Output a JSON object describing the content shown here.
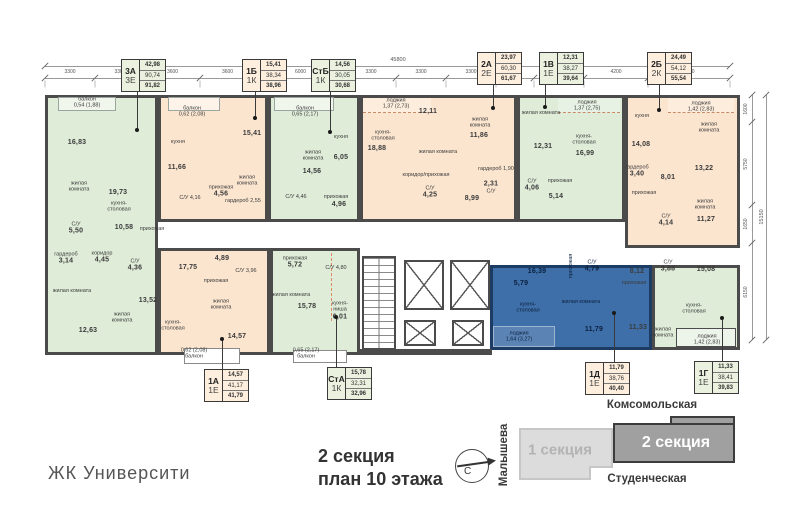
{
  "meta": {
    "project": "ЖК Университи",
    "title_line1": "2 секция",
    "title_line2": "план 10 этажа"
  },
  "site_plan": {
    "street_top": "Комсомольская",
    "street_bottom": "Студенческая",
    "street_left": "Малышева",
    "section1_label": "1 секция",
    "section2_label": "2 секция",
    "compass_letter": "С"
  },
  "dimensions": {
    "top_total": "45800",
    "top_segments": [
      "3300",
      "3300",
      "3600",
      "3600",
      "6000",
      "3300",
      "3300",
      "3300",
      "2500",
      "3300",
      "4200",
      "5400"
    ],
    "right_total": "15150",
    "right_segments": [
      "1600",
      "5750",
      "1650",
      "6150"
    ]
  },
  "colors": {
    "green": "#dfecd8",
    "orange": "#fbe5cf",
    "blue": "#3f6fa8",
    "wall": "#4b4b4b",
    "highlight_border": "#1c3c63"
  },
  "apartments": [
    {
      "id": "3a",
      "type": "3А",
      "format": "3Е",
      "living_area": "42,98",
      "area": "90,74",
      "total_area": "91,82",
      "color": "green",
      "tag": {
        "x": 121,
        "y": 59
      },
      "leader": {
        "x": 137,
        "y1": 91,
        "y2": 130,
        "dot": "y2"
      }
    },
    {
      "id": "1b",
      "type": "1Б",
      "format": "1К",
      "living_area": "15,41",
      "area": "38,34",
      "total_area": "38,96",
      "color": "orange",
      "tag": {
        "x": 242,
        "y": 59
      },
      "leader": {
        "x": 255,
        "y1": 91,
        "y2": 118,
        "dot": "y2"
      }
    },
    {
      "id": "stb",
      "type": "СтБ",
      "format": "1К",
      "living_area": "14,56",
      "area": "30,05",
      "total_area": "30,68",
      "color": "green",
      "tag": {
        "x": 311,
        "y": 59
      },
      "leader": {
        "x": 330,
        "y1": 91,
        "y2": 132,
        "dot": "y2"
      }
    },
    {
      "id": "2a",
      "type": "2А",
      "format": "2Е",
      "living_area": "23,97",
      "area": "60,30",
      "total_area": "61,67",
      "color": "orange",
      "tag": {
        "x": 477,
        "y": 52
      },
      "leader": {
        "x": 493,
        "y1": 84,
        "y2": 108,
        "dot": "y2"
      }
    },
    {
      "id": "1v",
      "type": "1В",
      "format": "1Е",
      "living_area": "12,31",
      "area": "38,27",
      "total_area": "39,64",
      "color": "green",
      "tag": {
        "x": 539,
        "y": 52
      },
      "leader": {
        "x": 545,
        "y1": 84,
        "y2": 107,
        "dot": "y2"
      }
    },
    {
      "id": "2b",
      "type": "2Б",
      "format": "2К",
      "living_area": "24,49",
      "area": "54,12",
      "total_area": "55,54",
      "color": "orange",
      "tag": {
        "x": 647,
        "y": 52
      },
      "leader": {
        "x": 659,
        "y1": 84,
        "y2": 110,
        "dot": "y2"
      }
    },
    {
      "id": "1a",
      "type": "1А",
      "format": "1Е",
      "living_area": "14,57",
      "area": "41,17",
      "total_area": "41,79",
      "color": "orange",
      "tag": {
        "x": 204,
        "y": 369
      },
      "leader": {
        "x": 222,
        "y1": 339,
        "y2": 369,
        "dot": "y1"
      }
    },
    {
      "id": "sta",
      "type": "СтА",
      "format": "1К",
      "living_area": "15,78",
      "area": "32,31",
      "total_area": "32,96",
      "color": "green",
      "tag": {
        "x": 327,
        "y": 367
      },
      "leader": {
        "x": 336,
        "y1": 317,
        "y2": 367,
        "dot": "y1"
      }
    },
    {
      "id": "1d",
      "type": "1Д",
      "format": "1Е",
      "living_area": "11,79",
      "area": "38,76",
      "total_area": "40,40",
      "color": "orange",
      "tag": {
        "x": 585,
        "y": 362
      },
      "leader": {
        "x": 614,
        "y1": 313,
        "y2": 362,
        "dot": "y1"
      }
    },
    {
      "id": "1g",
      "type": "1Г",
      "format": "1Е",
      "living_area": "11,33",
      "area": "38,41",
      "total_area": "39,83",
      "color": "green",
      "tag": {
        "x": 694,
        "y": 361
      },
      "leader": {
        "x": 722,
        "y1": 318,
        "y2": 361,
        "dot": "y1"
      }
    }
  ],
  "rooms": [
    {
      "apt": "3a",
      "x": 87,
      "y": 103,
      "lines": [
        "балкон",
        "0,54 (1,88)"
      ]
    },
    {
      "apt": "3a",
      "x": 77,
      "y": 143,
      "lines": [
        "16,83"
      ]
    },
    {
      "apt": "3a",
      "x": 79,
      "y": 187,
      "lines": [
        "жилая",
        "комната"
      ]
    },
    {
      "apt": "3a",
      "x": 118,
      "y": 193,
      "lines": [
        "19,73"
      ]
    },
    {
      "apt": "3a",
      "x": 119,
      "y": 207,
      "lines": [
        "кухня-",
        "столовая"
      ]
    },
    {
      "apt": "3a",
      "x": 76,
      "y": 229,
      "lines": [
        "С/У",
        "5,50"
      ]
    },
    {
      "apt": "3a",
      "x": 124,
      "y": 228,
      "lines": [
        "10,58"
      ]
    },
    {
      "apt": "3a",
      "x": 152,
      "y": 229,
      "lines": [
        "прихожая"
      ]
    },
    {
      "apt": "3a",
      "x": 66,
      "y": 259,
      "lines": [
        "гардероб",
        "3,14"
      ]
    },
    {
      "apt": "3a",
      "x": 102,
      "y": 258,
      "lines": [
        "коридор",
        "4,45"
      ]
    },
    {
      "apt": "3a",
      "x": 135,
      "y": 266,
      "lines": [
        "С/У",
        "4,36"
      ]
    },
    {
      "apt": "3a",
      "x": 148,
      "y": 301,
      "lines": [
        "13,52"
      ]
    },
    {
      "apt": "3a",
      "x": 122,
      "y": 318,
      "lines": [
        "жилая",
        "комната"
      ]
    },
    {
      "apt": "3a",
      "x": 72,
      "y": 291,
      "lines": [
        "жилая комната"
      ]
    },
    {
      "apt": "3a",
      "x": 88,
      "y": 331,
      "lines": [
        "12,63"
      ]
    },
    {
      "apt": "1b",
      "x": 192,
      "y": 112,
      "lines": [
        "балкон",
        "0,62 (2,08)"
      ]
    },
    {
      "apt": "1b",
      "x": 178,
      "y": 142,
      "lines": [
        "кухня"
      ]
    },
    {
      "apt": "1b",
      "x": 177,
      "y": 168,
      "lines": [
        "11,66"
      ]
    },
    {
      "apt": "1b",
      "x": 252,
      "y": 134,
      "lines": [
        "15,41"
      ]
    },
    {
      "apt": "1b",
      "x": 247,
      "y": 181,
      "lines": [
        "жилая",
        "комната"
      ]
    },
    {
      "apt": "1b",
      "x": 190,
      "y": 198,
      "lines": [
        "С/У 4,16"
      ]
    },
    {
      "apt": "1b",
      "x": 221,
      "y": 192,
      "lines": [
        "прихожая",
        "4,56"
      ]
    },
    {
      "apt": "1b",
      "x": 243,
      "y": 201,
      "lines": [
        "гардероб 2,55"
      ]
    },
    {
      "apt": "stb",
      "x": 305,
      "y": 112,
      "lines": [
        "балкон",
        "0,65 (2,17)"
      ]
    },
    {
      "apt": "stb",
      "x": 313,
      "y": 156,
      "lines": [
        "жилая",
        "комната"
      ]
    },
    {
      "apt": "stb",
      "x": 312,
      "y": 172,
      "lines": [
        "14,56"
      ]
    },
    {
      "apt": "stb",
      "x": 341,
      "y": 137,
      "lines": [
        "кухня"
      ]
    },
    {
      "apt": "stb",
      "x": 341,
      "y": 158,
      "lines": [
        "6,05"
      ]
    },
    {
      "apt": "stb",
      "x": 296,
      "y": 197,
      "lines": [
        "С/У 4,46"
      ]
    },
    {
      "apt": "stb",
      "x": 336,
      "y": 197,
      "lines": [
        "прихожая"
      ]
    },
    {
      "apt": "stb",
      "x": 339,
      "y": 205,
      "lines": [
        "4,96"
      ]
    },
    {
      "apt": "2a",
      "x": 396,
      "y": 104,
      "lines": [
        "лоджия",
        "1,37 (2,73)"
      ]
    },
    {
      "apt": "2a",
      "x": 383,
      "y": 136,
      "lines": [
        "кухня-",
        "столовая"
      ]
    },
    {
      "apt": "2a",
      "x": 377,
      "y": 149,
      "lines": [
        "18,88"
      ]
    },
    {
      "apt": "2a",
      "x": 428,
      "y": 112,
      "lines": [
        "12,11"
      ]
    },
    {
      "apt": "2a",
      "x": 438,
      "y": 152,
      "lines": [
        "жилая комната"
      ]
    },
    {
      "apt": "2a",
      "x": 480,
      "y": 123,
      "lines": [
        "жилая",
        "комната"
      ]
    },
    {
      "apt": "2a",
      "x": 479,
      "y": 136,
      "lines": [
        "11,86"
      ]
    },
    {
      "apt": "2a",
      "x": 426,
      "y": 175,
      "lines": [
        "коридор/прихожая"
      ]
    },
    {
      "apt": "2a",
      "x": 472,
      "y": 199,
      "lines": [
        "8,99"
      ]
    },
    {
      "apt": "2a",
      "x": 430,
      "y": 193,
      "lines": [
        "С/У",
        "4,25"
      ]
    },
    {
      "apt": "2a",
      "x": 491,
      "y": 188,
      "lines": [
        "2,31",
        "С/У"
      ]
    },
    {
      "apt": "2a",
      "x": 496,
      "y": 169,
      "lines": [
        "гардероб 1,90"
      ]
    },
    {
      "apt": "1v",
      "x": 587,
      "y": 106,
      "lines": [
        "лоджия",
        "1,37 (2,75)"
      ]
    },
    {
      "apt": "1v",
      "x": 541,
      "y": 113,
      "lines": [
        "жилая комната"
      ]
    },
    {
      "apt": "1v",
      "x": 543,
      "y": 147,
      "lines": [
        "12,31"
      ]
    },
    {
      "apt": "1v",
      "x": 584,
      "y": 140,
      "lines": [
        "кухня-",
        "столовая"
      ]
    },
    {
      "apt": "1v",
      "x": 585,
      "y": 154,
      "lines": [
        "16,99"
      ]
    },
    {
      "apt": "1v",
      "x": 532,
      "y": 186,
      "lines": [
        "С/У",
        "4,06"
      ]
    },
    {
      "apt": "1v",
      "x": 560,
      "y": 181,
      "lines": [
        "прихожая"
      ]
    },
    {
      "apt": "1v",
      "x": 556,
      "y": 197,
      "lines": [
        "5,14"
      ]
    },
    {
      "apt": "2b",
      "x": 701,
      "y": 107,
      "lines": [
        "лоджия",
        "1,42 (2,83)"
      ]
    },
    {
      "apt": "2b",
      "x": 642,
      "y": 116,
      "lines": [
        "кухня"
      ]
    },
    {
      "apt": "2b",
      "x": 641,
      "y": 145,
      "lines": [
        "14,08"
      ]
    },
    {
      "apt": "2b",
      "x": 709,
      "y": 128,
      "lines": [
        "жилая",
        "комната"
      ]
    },
    {
      "apt": "2b",
      "x": 704,
      "y": 169,
      "lines": [
        "13,22"
      ]
    },
    {
      "apt": "2b",
      "x": 637,
      "y": 172,
      "lines": [
        "гардероб",
        "3,40"
      ]
    },
    {
      "apt": "2b",
      "x": 668,
      "y": 178,
      "lines": [
        "8,01"
      ]
    },
    {
      "apt": "2b",
      "x": 644,
      "y": 193,
      "lines": [
        "прихожая"
      ]
    },
    {
      "apt": "2b",
      "x": 705,
      "y": 205,
      "lines": [
        "жилая",
        "комната"
      ]
    },
    {
      "apt": "2b",
      "x": 706,
      "y": 220,
      "lines": [
        "11,27"
      ]
    },
    {
      "apt": "2b",
      "x": 666,
      "y": 221,
      "lines": [
        "С/У",
        "4,14"
      ]
    },
    {
      "apt": "1a",
      "x": 188,
      "y": 268,
      "lines": [
        "17,75"
      ]
    },
    {
      "apt": "1a",
      "x": 173,
      "y": 326,
      "lines": [
        "кухня-",
        "столовая"
      ]
    },
    {
      "apt": "1a",
      "x": 222,
      "y": 259,
      "lines": [
        "4,89"
      ]
    },
    {
      "apt": "1a",
      "x": 216,
      "y": 281,
      "lines": [
        "прихожая"
      ]
    },
    {
      "apt": "1a",
      "x": 246,
      "y": 271,
      "lines": [
        "С/У 3,96"
      ]
    },
    {
      "apt": "1a",
      "x": 221,
      "y": 305,
      "lines": [
        "жилая",
        "комната"
      ]
    },
    {
      "apt": "1a",
      "x": 237,
      "y": 337,
      "lines": [
        "14,57"
      ]
    },
    {
      "apt": "1a",
      "x": 194,
      "y": 354,
      "lines": [
        "0,62 (2,08)",
        "балкон"
      ]
    },
    {
      "apt": "sta",
      "x": 295,
      "y": 263,
      "lines": [
        "прихожая",
        "5,72"
      ]
    },
    {
      "apt": "sta",
      "x": 336,
      "y": 268,
      "lines": [
        "С/У 4,80"
      ]
    },
    {
      "apt": "sta",
      "x": 291,
      "y": 295,
      "lines": [
        "жилая комната"
      ]
    },
    {
      "apt": "sta",
      "x": 307,
      "y": 307,
      "lines": [
        "15,78"
      ]
    },
    {
      "apt": "sta",
      "x": 340,
      "y": 311,
      "lines": [
        "кухня-",
        "ниша",
        "6,01"
      ]
    },
    {
      "apt": "sta",
      "x": 306,
      "y": 354,
      "lines": [
        "0,65 (2,17)",
        "балкон"
      ]
    },
    {
      "apt": "1d",
      "x": 537,
      "y": 272,
      "lines": [
        "16,39"
      ],
      "c": "blue"
    },
    {
      "apt": "1d",
      "x": 528,
      "y": 308,
      "lines": [
        "кухня-",
        "столовая"
      ],
      "c": "blue"
    },
    {
      "apt": "1d",
      "x": 571,
      "y": 266,
      "lines": [
        "прихожая"
      ],
      "c": "blue",
      "rot": true
    },
    {
      "apt": "1d",
      "x": 521,
      "y": 284,
      "lines": [
        "5,79"
      ],
      "c": "blue"
    },
    {
      "apt": "1d",
      "x": 592,
      "y": 267,
      "lines": [
        "С/У",
        "4,79"
      ],
      "c": "blue"
    },
    {
      "apt": "1d",
      "x": 581,
      "y": 302,
      "lines": [
        "жилая комната"
      ],
      "c": "blue"
    },
    {
      "apt": "1d",
      "x": 594,
      "y": 330,
      "lines": [
        "11,79"
      ],
      "c": "blue"
    },
    {
      "apt": "1d",
      "x": 519,
      "y": 337,
      "lines": [
        "лоджия",
        "1,64 (3,27)"
      ],
      "c": "blue"
    },
    {
      "apt": "1g",
      "x": 637,
      "y": 272,
      "lines": [
        "8,12"
      ]
    },
    {
      "apt": "1g",
      "x": 634,
      "y": 283,
      "lines": [
        "прихожая"
      ]
    },
    {
      "apt": "1g",
      "x": 668,
      "y": 267,
      "lines": [
        "С/У",
        "3,88"
      ]
    },
    {
      "apt": "1g",
      "x": 706,
      "y": 270,
      "lines": [
        "15,08"
      ]
    },
    {
      "apt": "1g",
      "x": 694,
      "y": 309,
      "lines": [
        "кухня-",
        "столовая"
      ]
    },
    {
      "apt": "1g",
      "x": 638,
      "y": 328,
      "lines": [
        "11,33"
      ]
    },
    {
      "apt": "1g",
      "x": 663,
      "y": 333,
      "lines": [
        "жилая",
        "комната"
      ]
    },
    {
      "apt": "1g",
      "x": 707,
      "y": 340,
      "lines": [
        "лоджия",
        "1,42 (2,83)"
      ]
    }
  ]
}
